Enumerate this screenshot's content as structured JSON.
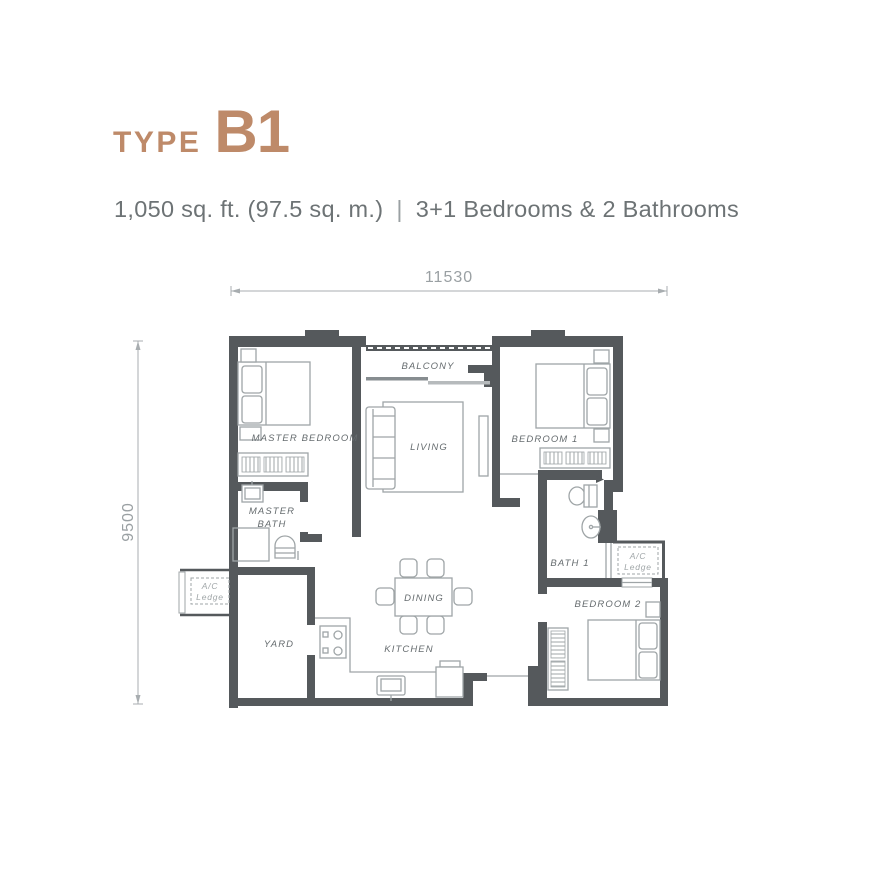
{
  "header": {
    "type_label": "TYPE",
    "type_value": "B1",
    "area_text": "1,050 sq. ft. (97.5 sq. m.)",
    "separator": "|",
    "config_text": "3+1 Bedrooms & 2 Bathrooms"
  },
  "dimensions": {
    "width_mm": "11530",
    "height_mm": "9500"
  },
  "rooms": {
    "master_bedroom": "MASTER BEDROOM",
    "master_bath_line1": "MASTER",
    "master_bath_line2": "BATH",
    "balcony": "BALCONY",
    "living": "LIVING",
    "bedroom1": "BEDROOM 1",
    "bath1": "BATH 1",
    "bedroom2": "BEDROOM 2",
    "yard": "YARD",
    "dining": "DINING",
    "kitchen": "KITCHEN",
    "ac_line1": "A/C",
    "ac_line2": "Ledge"
  },
  "colors": {
    "accent": "#BE8A69",
    "wall": "#55595C",
    "furn": "#9FA5A7",
    "label": "#666C6F",
    "subtitle": "#6D7375"
  }
}
